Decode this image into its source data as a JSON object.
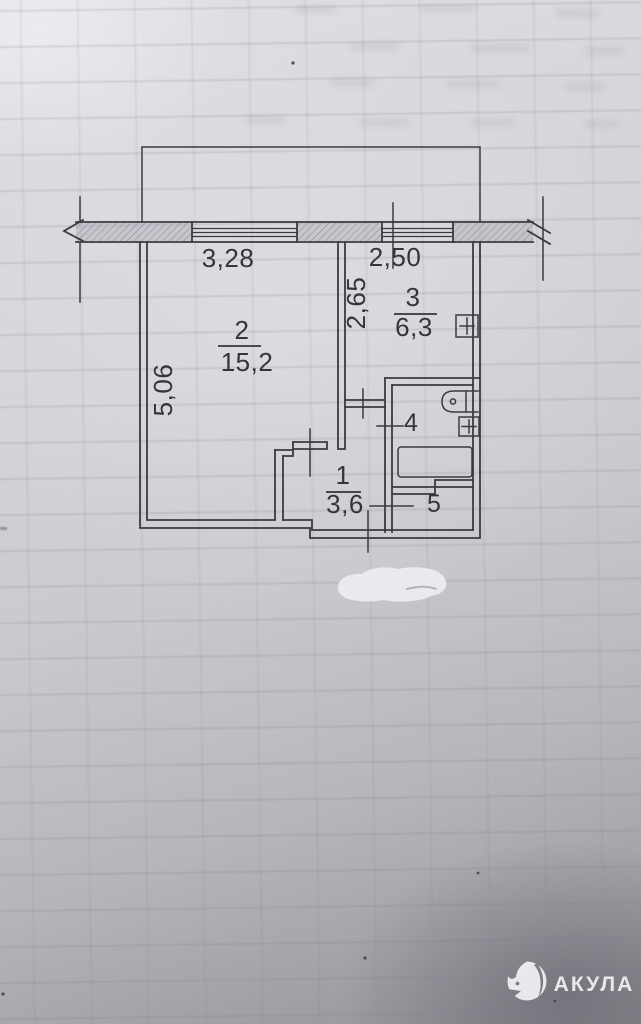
{
  "plan": {
    "dimensions": {
      "window_left": "3,28",
      "window_right": "2,50",
      "kitchen_depth": "2,65",
      "living_depth": "5,06"
    },
    "rooms": {
      "hall": {
        "number": "1",
        "area": "3,6"
      },
      "living": {
        "number": "2",
        "area": "15,2"
      },
      "kitchen": {
        "number": "3",
        "area": "6,3"
      },
      "bathroom": {
        "number": "4"
      },
      "storage": {
        "number": "5"
      }
    },
    "symbols": [
      "window-symbol",
      "wall-hatching",
      "door-opening-tick",
      "vent-shaft-plus-icon",
      "sink-icon",
      "bathtub-icon"
    ]
  },
  "watermark": {
    "brand": "АКУЛА",
    "icon": "shark-logo-icon"
  },
  "colors": {
    "paper": "#cfced4",
    "ink": "#3b3a41",
    "watermark": "#f2f1f5",
    "correction_fluid": "#ebebee"
  }
}
